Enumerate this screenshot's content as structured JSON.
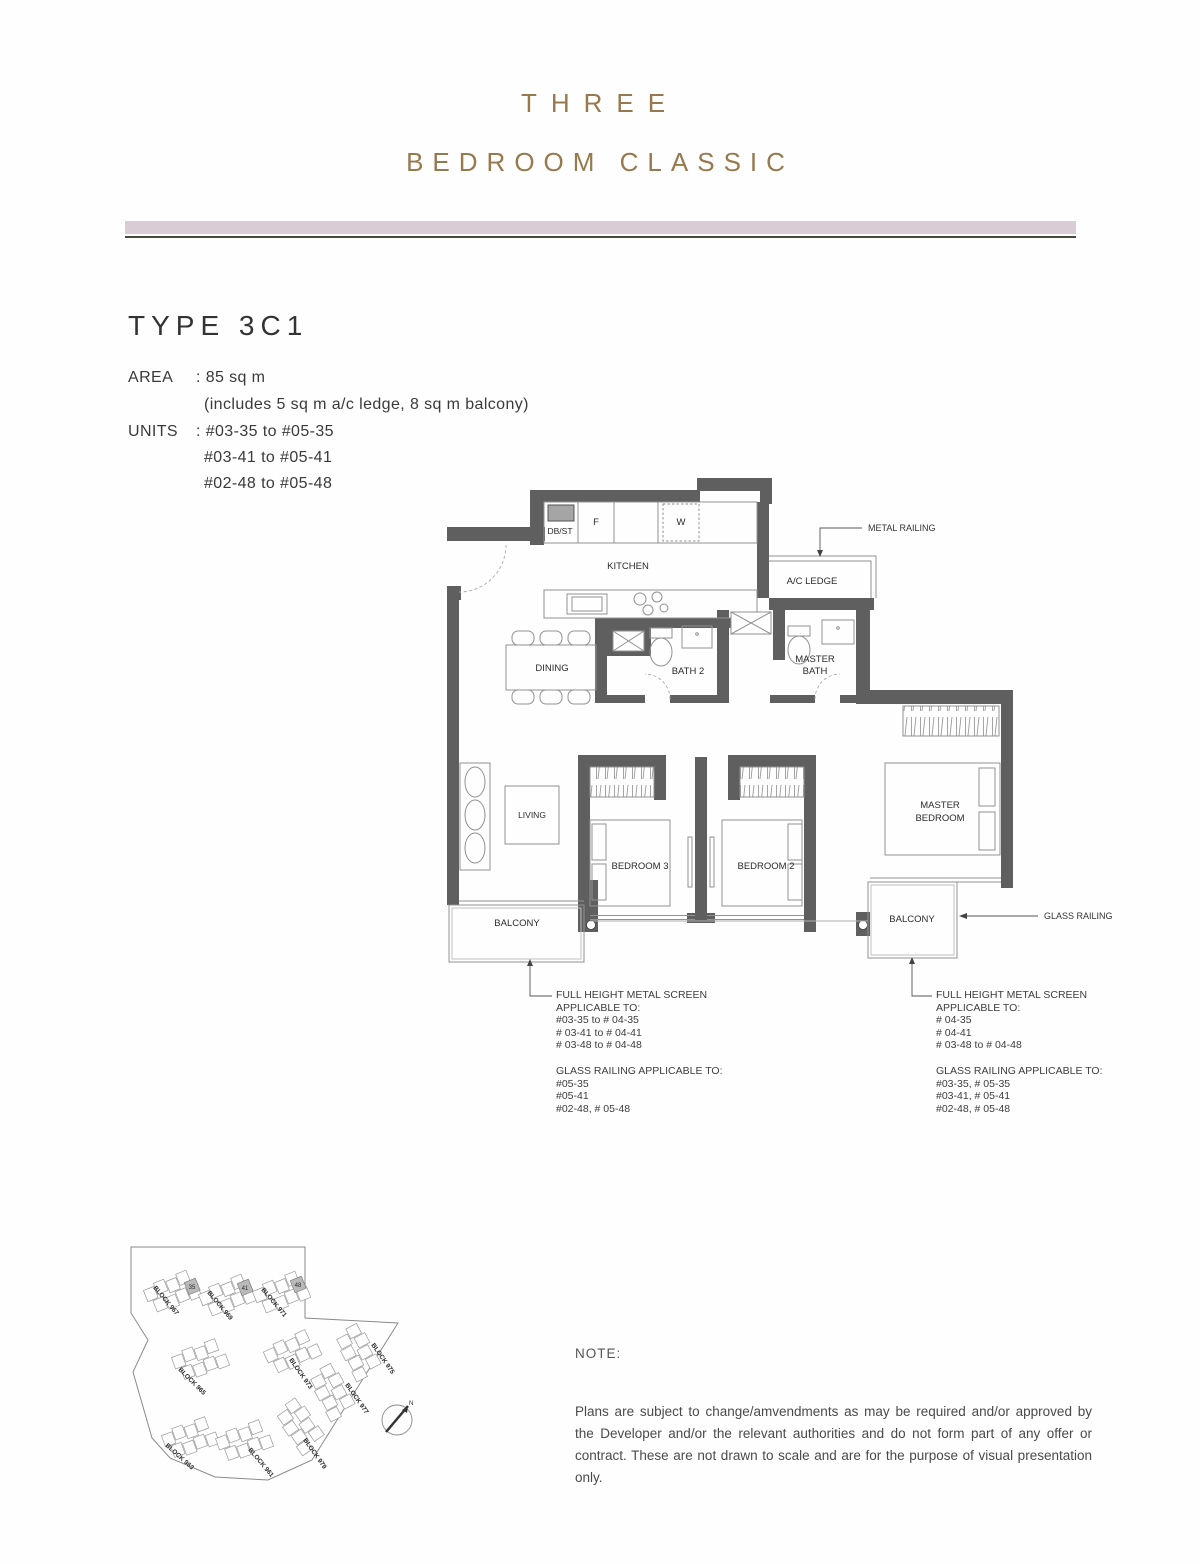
{
  "header": {
    "title_line1": "THREE",
    "title_line2": "BEDROOM CLASSIC"
  },
  "unit_type": {
    "title": "TYPE 3C1",
    "area_label": "AREA",
    "area_value": ": 85 sq m",
    "area_note": "(includes 5 sq m a/c ledge, 8 sq m balcony)",
    "units_label": "UNITS",
    "units_lines": [
      ": #03-35 to #05-35",
      "#03-41 to #05-41",
      "#02-48 to #05-48"
    ]
  },
  "floorplan": {
    "rooms": {
      "dbst": "DB/ST",
      "fridge": "F",
      "washer": "W",
      "kitchen": "KITCHEN",
      "ac_ledge": "A/C LEDGE",
      "dining": "DINING",
      "bath2": "BATH 2",
      "master_bath_line1": "MASTER",
      "master_bath_line2": "BATH",
      "living": "LIVING",
      "bedroom3": "BEDROOM 3",
      "bedroom2": "BEDROOM 2",
      "master_bedroom_line1": "MASTER",
      "master_bedroom_line2": "BEDROOM",
      "balcony_left": "BALCONY",
      "balcony_right": "BALCONY"
    },
    "annotations": {
      "metal_railing": "METAL RAILING",
      "glass_railing": "GLASS RAILING",
      "metal_screen_left": [
        "FULL HEIGHT METAL SCREEN",
        "APPLICABLE TO:",
        "#03-35 to # 04-35",
        "# 03-41 to # 04-41",
        "# 03-48 to # 04-48"
      ],
      "glass_left": [
        "GLASS RAILING APPLICABLE TO:",
        "#05-35",
        "#05-41",
        "#02-48, # 05-48"
      ],
      "metal_screen_right": [
        "FULL HEIGHT METAL SCREEN",
        "APPLICABLE TO:",
        "# 04-35",
        "# 04-41",
        "# 03-48 to # 04-48"
      ],
      "glass_right": [
        "GLASS RAILING APPLICABLE TO:",
        "#03-35, # 05-35",
        "#03-41, # 05-41",
        "#02-48, # 05-48"
      ]
    }
  },
  "siteplan": {
    "blocks": [
      {
        "label": "BLOCK 967"
      },
      {
        "label": "BLOCK 969"
      },
      {
        "label": "BLOCK 971"
      },
      {
        "label": "BLOCK 965"
      },
      {
        "label": "BLOCK 973"
      },
      {
        "label": "BLOCK 975"
      },
      {
        "label": "BLOCK 977"
      },
      {
        "label": "BLOCK 963"
      },
      {
        "label": "BLOCK 961"
      },
      {
        "label": "BLOCK 979"
      }
    ],
    "highlighted_units": [
      "35",
      "41",
      "48"
    ],
    "compass_label": "N"
  },
  "note": {
    "label": "NOTE:",
    "body": "Plans are subject to change/amvendments as may be required and/or approved by the Developer and/or the relevant authorities and do not form part of any offer or contract. These are not drawn to scale and are for the purpose of visual presentation only."
  },
  "colors": {
    "accent_gold": "#97794e",
    "bar_pink": "#d9ccd4",
    "wall_gray": "#5f5f5f"
  }
}
